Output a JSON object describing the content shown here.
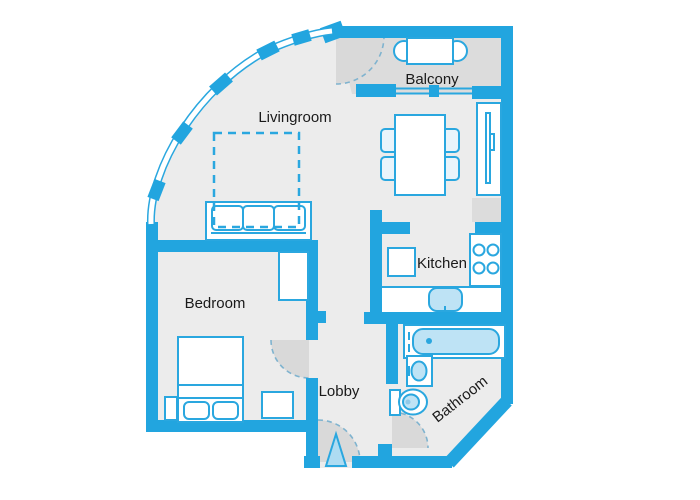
{
  "diagram": {
    "type": "apartment floor plan",
    "background": "#FFFFFF"
  },
  "colors": {
    "wall": "#22A5DF",
    "furniture_outline": "#2AA7DF",
    "room_floor": "#ECECEC",
    "balcony_floor": "#DCDCDC",
    "door_swing": "#D9D9D9",
    "water_fixture_fill": "#BEE3F5",
    "basin_fill": "#A9D7EF",
    "chair_fill": "#E9F4FB",
    "entrance_arrow_fill": "#AEDCF2",
    "label_text": "#1A1A1A"
  },
  "rooms": {
    "livingroom": {
      "label": "Livingroom"
    },
    "balcony": {
      "label": "Balcony"
    },
    "kitchen": {
      "label": "Kitchen"
    },
    "bedroom": {
      "label": "Bedroom"
    },
    "lobby": {
      "label": "Lobby"
    },
    "bathroom": {
      "label": "Bathroom"
    }
  },
  "furniture": {
    "livingroom": [
      "dashed-rug",
      "sofa-3-seat",
      "dining-table",
      "dining-chairs-x4",
      "shelf-cabinet"
    ],
    "balcony": [
      "round-chairs-x2",
      "table"
    ],
    "kitchen": [
      "fridge",
      "stove-4-burners",
      "counter",
      "sink"
    ],
    "bedroom": [
      "double-bed",
      "pillows-x2",
      "wardrobe",
      "nightstand",
      "dresser"
    ],
    "bathroom": [
      "bathtub",
      "washbasin",
      "toilet"
    ],
    "lobby": [
      "entrance-arrow"
    ]
  },
  "doors": [
    "balcony-door-swing",
    "bedroom-door-swing",
    "bathroom-door-swing",
    "entrance-door-swing"
  ],
  "windows": [
    "curved-facade-window-band",
    "balcony-sliding-window"
  ]
}
